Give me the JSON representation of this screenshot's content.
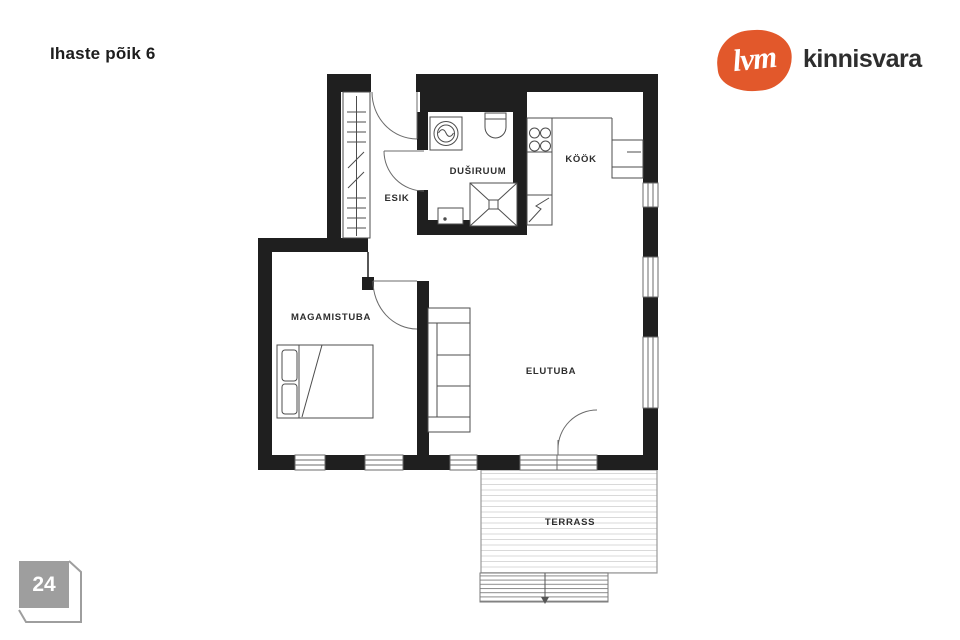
{
  "header": {
    "title": "Ihaste põik 6"
  },
  "logo": {
    "mark": "lvm",
    "name": "kinnisvara",
    "brand_orange": "#e2582b"
  },
  "floorplan": {
    "wall_color": "#1f1f1f",
    "rooms": {
      "esik": "ESIK",
      "dusiruum": "DUŠIRUUM",
      "kook": "KÖÖK",
      "magamistuba": "MAGAMISTUBA",
      "elutuba": "ELUTUBA",
      "terrass": "TERRASS"
    }
  },
  "footer": {
    "page_number": "24",
    "badge_color": "#9e9e9e"
  }
}
